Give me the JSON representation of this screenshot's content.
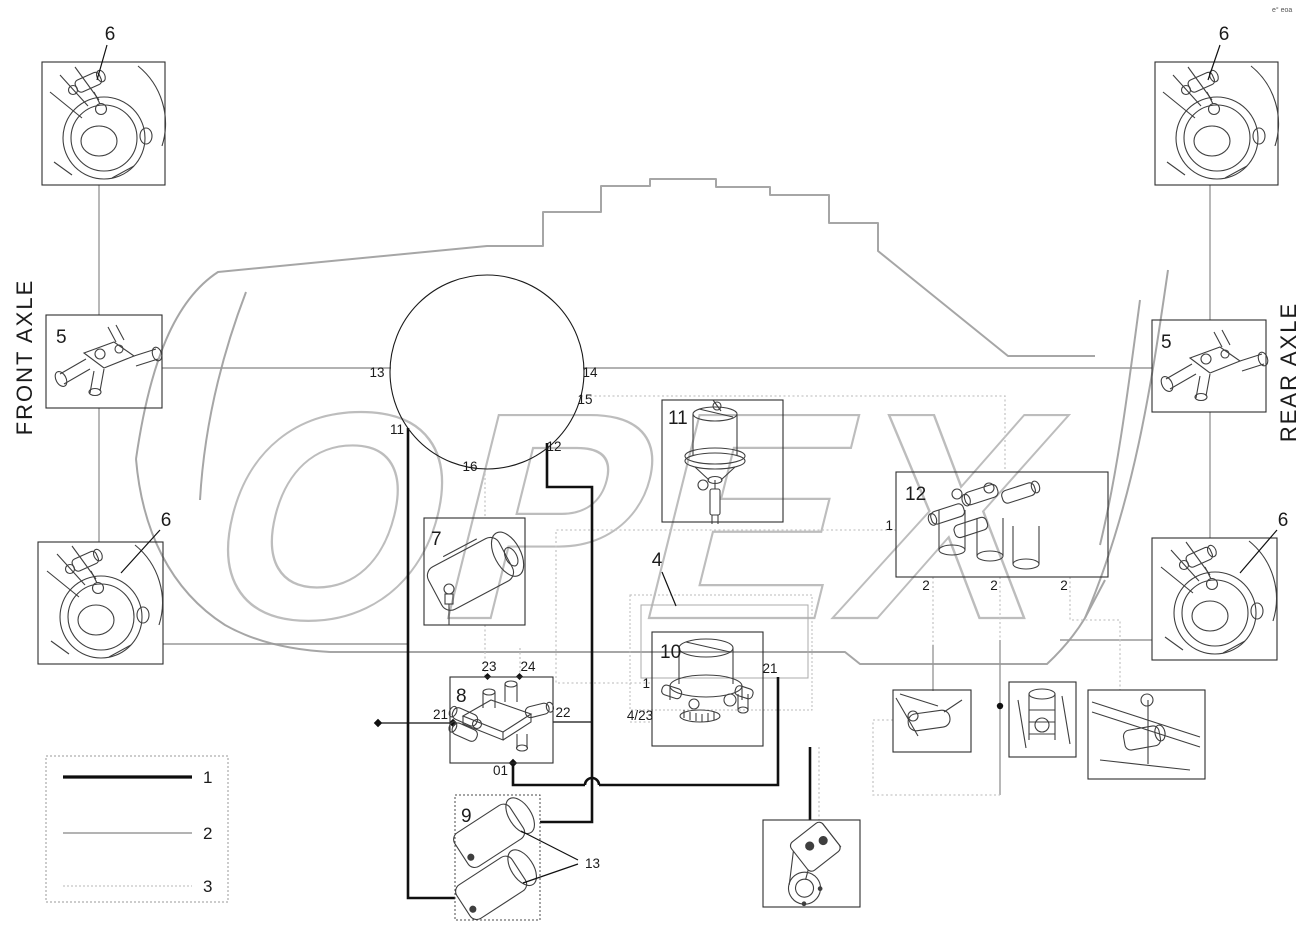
{
  "title_note": "e° eoa",
  "watermark": {
    "text": "OPEX",
    "color": "#bdbdbd"
  },
  "axles": {
    "front": "FRONT AXLE",
    "rear": "REAR AXLE"
  },
  "colors": {
    "line_thick": "#101010",
    "line_medium": "#999999",
    "line_light": "#c6c6c6",
    "tractor_outline": "#a6a6a6",
    "watermark": "#bdbdbd"
  },
  "legend": {
    "line1": "1",
    "line2": "2",
    "line3": "3"
  },
  "components": {
    "hub_tl": {
      "label": "6"
    },
    "hub_tr": {
      "label": "6"
    },
    "hub_bl": {
      "label": "6"
    },
    "hub_br": {
      "label": "6"
    },
    "dist_left": {
      "label": "5"
    },
    "dist_right": {
      "label": "5"
    },
    "tank": {
      "label": "7"
    },
    "valve_block": {
      "label": "8"
    },
    "twin_tanks": {
      "label": "9",
      "callout": "13"
    },
    "air_dryer": {
      "label": "10",
      "port_1": "1",
      "port_4_23": "4/23",
      "port_21": "21"
    },
    "compressor": {
      "label": "11"
    },
    "protection_valve": {
      "label": "12",
      "port_1": "1",
      "port_2a": "2",
      "port_2b": "2",
      "port_2c": "2"
    },
    "dryer_assembly": {
      "label": "4"
    }
  },
  "valve8_ports": {
    "p21": "21",
    "p22": "22",
    "p23": "23",
    "p24": "24",
    "p01": "01"
  },
  "lines": {
    "l11": "11",
    "l12": "12",
    "l13": "13",
    "l14": "14",
    "l15": "15",
    "l16": "16"
  }
}
